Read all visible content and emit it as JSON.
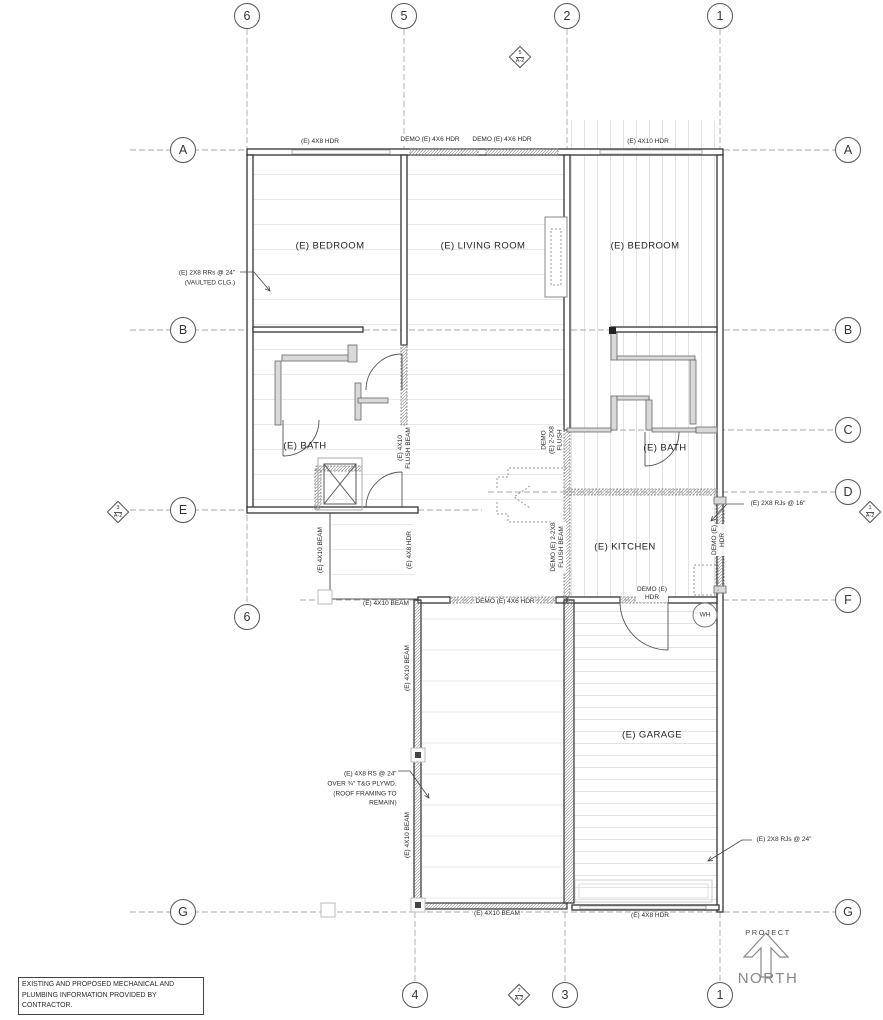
{
  "plan": {
    "note": "EXISTING AND PROPOSED MECHANICAL AND\nPLUMBING INFORMATION PROVIDED BY CONTRACTOR.",
    "north_arrow": {
      "top": "PROJECT",
      "bottom": "NORTH"
    },
    "wh_label": "WH",
    "rooms": [
      {
        "text": "(E) BEDROOM",
        "x": 330,
        "y": 246
      },
      {
        "text": "(E) LIVING ROOM",
        "x": 483,
        "y": 246
      },
      {
        "text": "(E) BEDROOM",
        "x": 645,
        "y": 246
      },
      {
        "text": "(E) BATH",
        "x": 305,
        "y": 446
      },
      {
        "text": "(E) BATH",
        "x": 665,
        "y": 448
      },
      {
        "text": "(E) KITCHEN",
        "x": 625,
        "y": 547
      },
      {
        "text": "(E) GARAGE",
        "x": 652,
        "y": 735
      }
    ],
    "grid_bubbles": [
      {
        "label": "6",
        "x": 247,
        "y": 16
      },
      {
        "label": "5",
        "x": 404,
        "y": 16
      },
      {
        "label": "2",
        "x": 567,
        "y": 16
      },
      {
        "label": "1",
        "x": 720,
        "y": 16
      },
      {
        "label": "A",
        "x": 183,
        "y": 150
      },
      {
        "label": "B",
        "x": 183,
        "y": 330
      },
      {
        "label": "E",
        "x": 183,
        "y": 510
      },
      {
        "label": "G",
        "x": 183,
        "y": 912
      },
      {
        "label": "6",
        "x": 247,
        "y": 617
      },
      {
        "label": "A",
        "x": 848,
        "y": 150
      },
      {
        "label": "B",
        "x": 848,
        "y": 330
      },
      {
        "label": "C",
        "x": 848,
        "y": 430
      },
      {
        "label": "D",
        "x": 848,
        "y": 492
      },
      {
        "label": "F",
        "x": 848,
        "y": 600
      },
      {
        "label": "G",
        "x": 848,
        "y": 912
      },
      {
        "label": "4",
        "x": 415,
        "y": 995
      },
      {
        "label": "3",
        "x": 565,
        "y": 995
      },
      {
        "label": "1",
        "x": 720,
        "y": 995
      }
    ],
    "section_markers": [
      {
        "num": "5",
        "sheet": "A-2",
        "x": 520,
        "y": 57
      },
      {
        "num": "3",
        "sheet": "A-2",
        "x": 118,
        "y": 512
      },
      {
        "num": "1",
        "sheet": "A-2",
        "x": 870,
        "y": 512
      },
      {
        "num": "7",
        "sheet": "A-2",
        "x": 519,
        "y": 995
      }
    ],
    "wall_labels": [
      {
        "text": "(E) 4X8 HDR",
        "x": 320,
        "y": 142,
        "rot": 0
      },
      {
        "text": "DEMO (E) 4X6 HDR",
        "x": 430,
        "y": 140,
        "rot": 0
      },
      {
        "text": "DEMO (E) 4X6 HDR",
        "x": 502,
        "y": 140,
        "rot": 0
      },
      {
        "text": "(E) 4X10 HDR",
        "x": 648,
        "y": 142,
        "rot": 0
      },
      {
        "text": "(E) 4X10\nFLUSH BEAM",
        "x": 405,
        "y": 448,
        "rot": -90
      },
      {
        "text": "DEMO\n(E) 2-2X8\nFLUSH",
        "x": 552,
        "y": 440,
        "rot": -90
      },
      {
        "text": "DEMO (E) 2-2X8\nFLUSH BEAM",
        "x": 558,
        "y": 547,
        "rot": -90
      },
      {
        "text": "(E) 4X10 BEAM",
        "x": 321,
        "y": 550,
        "rot": -90
      },
      {
        "text": "(E) 4X8 HDR",
        "x": 410,
        "y": 550,
        "rot": -90
      },
      {
        "text": "DEMO (E)\nHDR",
        "x": 719,
        "y": 540,
        "rot": -90
      },
      {
        "text": "(E) 4X10 BEAM",
        "x": 386,
        "y": 604,
        "rot": 0
      },
      {
        "text": "DEMO (E) 4X6 HDR",
        "x": 505,
        "y": 602,
        "rot": 0
      },
      {
        "text": "DEMO (E)\nHDR",
        "x": 652,
        "y": 594,
        "rot": 0
      },
      {
        "text": "(E) 4X10 BEAM",
        "x": 408,
        "y": 668,
        "rot": -90
      },
      {
        "text": "(E) 4X10 BEAM",
        "x": 408,
        "y": 835,
        "rot": -90
      },
      {
        "text": "(E) 4X10 BEAM",
        "x": 497,
        "y": 914,
        "rot": 0
      },
      {
        "text": "(E) 4X8 HDR",
        "x": 650,
        "y": 916,
        "rot": 0
      }
    ],
    "annotations": [
      {
        "lines": "(E) 2X8 RRs @ 24\"\n(VAULTED CLG.)",
        "x": 207,
        "y": 278,
        "align": "right"
      },
      {
        "lines": "(E) 2X8 RJs @ 16\"",
        "x": 778,
        "y": 504,
        "align": "left"
      },
      {
        "lines": "(E) 4X8 RS @ 24\"\nOVER ¾\" T&G PLYWD.\n(ROOF FRAMING TO\nREMAIN)",
        "x": 362,
        "y": 789,
        "align": "right"
      },
      {
        "lines": "(E) 2X8 RJs @ 24\"",
        "x": 784,
        "y": 840,
        "align": "left"
      }
    ]
  }
}
